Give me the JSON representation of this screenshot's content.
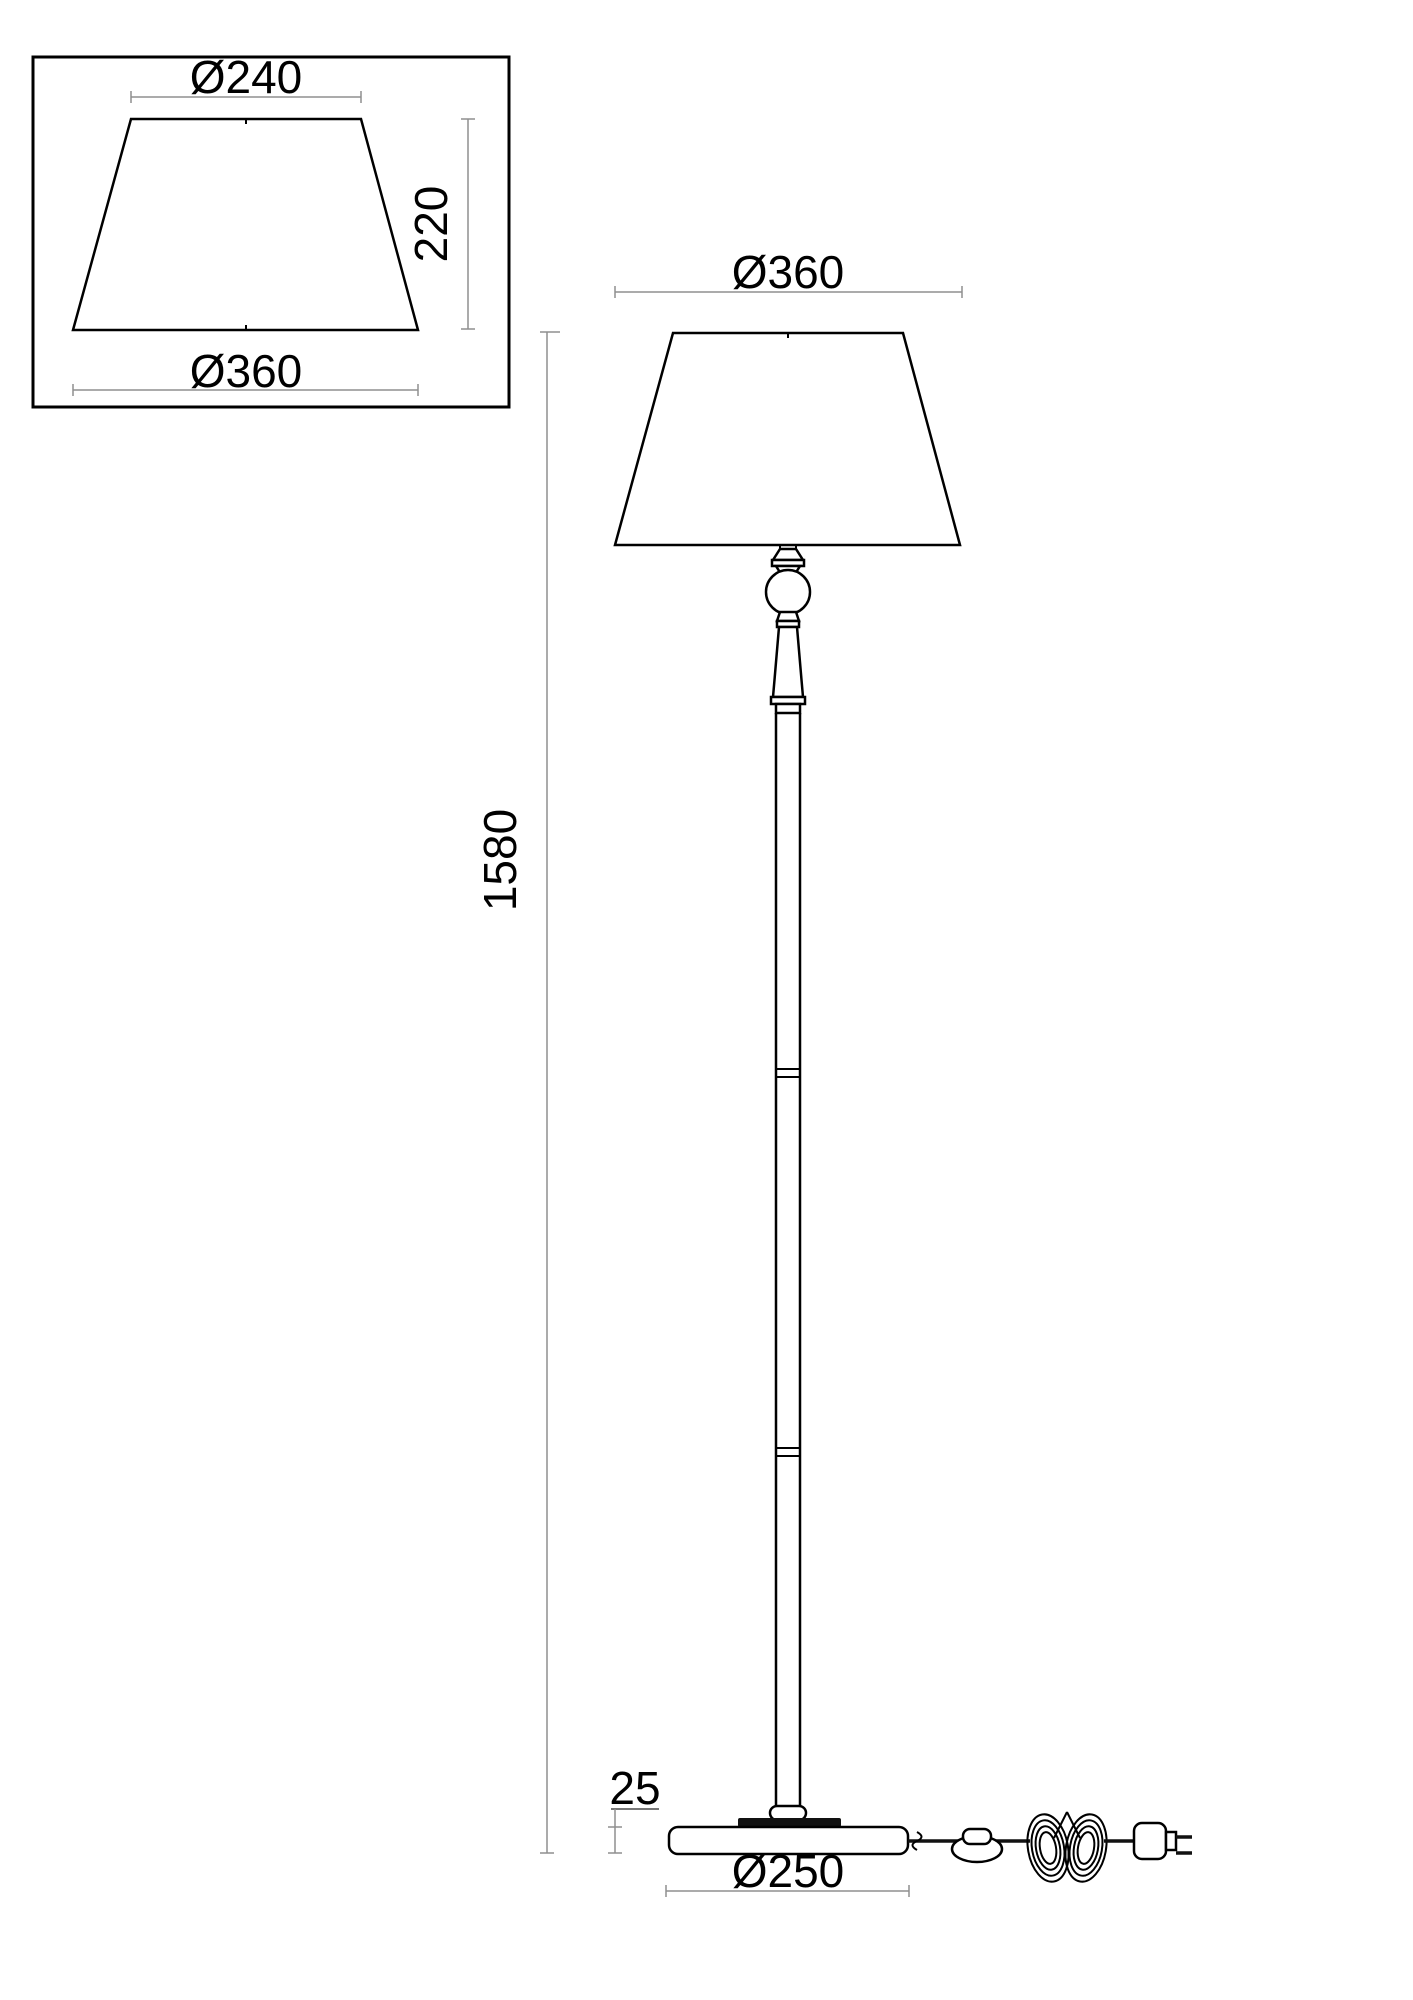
{
  "drawing": {
    "type": "technical dimension drawing",
    "subject": "floor lamp with conical shade, turned stem, round base, inline foot switch and plug",
    "background": "#ffffff",
    "line_color": "#000000",
    "dim_color": "#8f8f8f",
    "shade_detail": {
      "top_diameter": "Ø240",
      "height": "220",
      "bottom_diameter": "Ø360"
    },
    "lamp": {
      "shade_diameter": "Ø360",
      "total_height": "1580",
      "base_height": "25",
      "base_diameter": "Ø250"
    }
  }
}
